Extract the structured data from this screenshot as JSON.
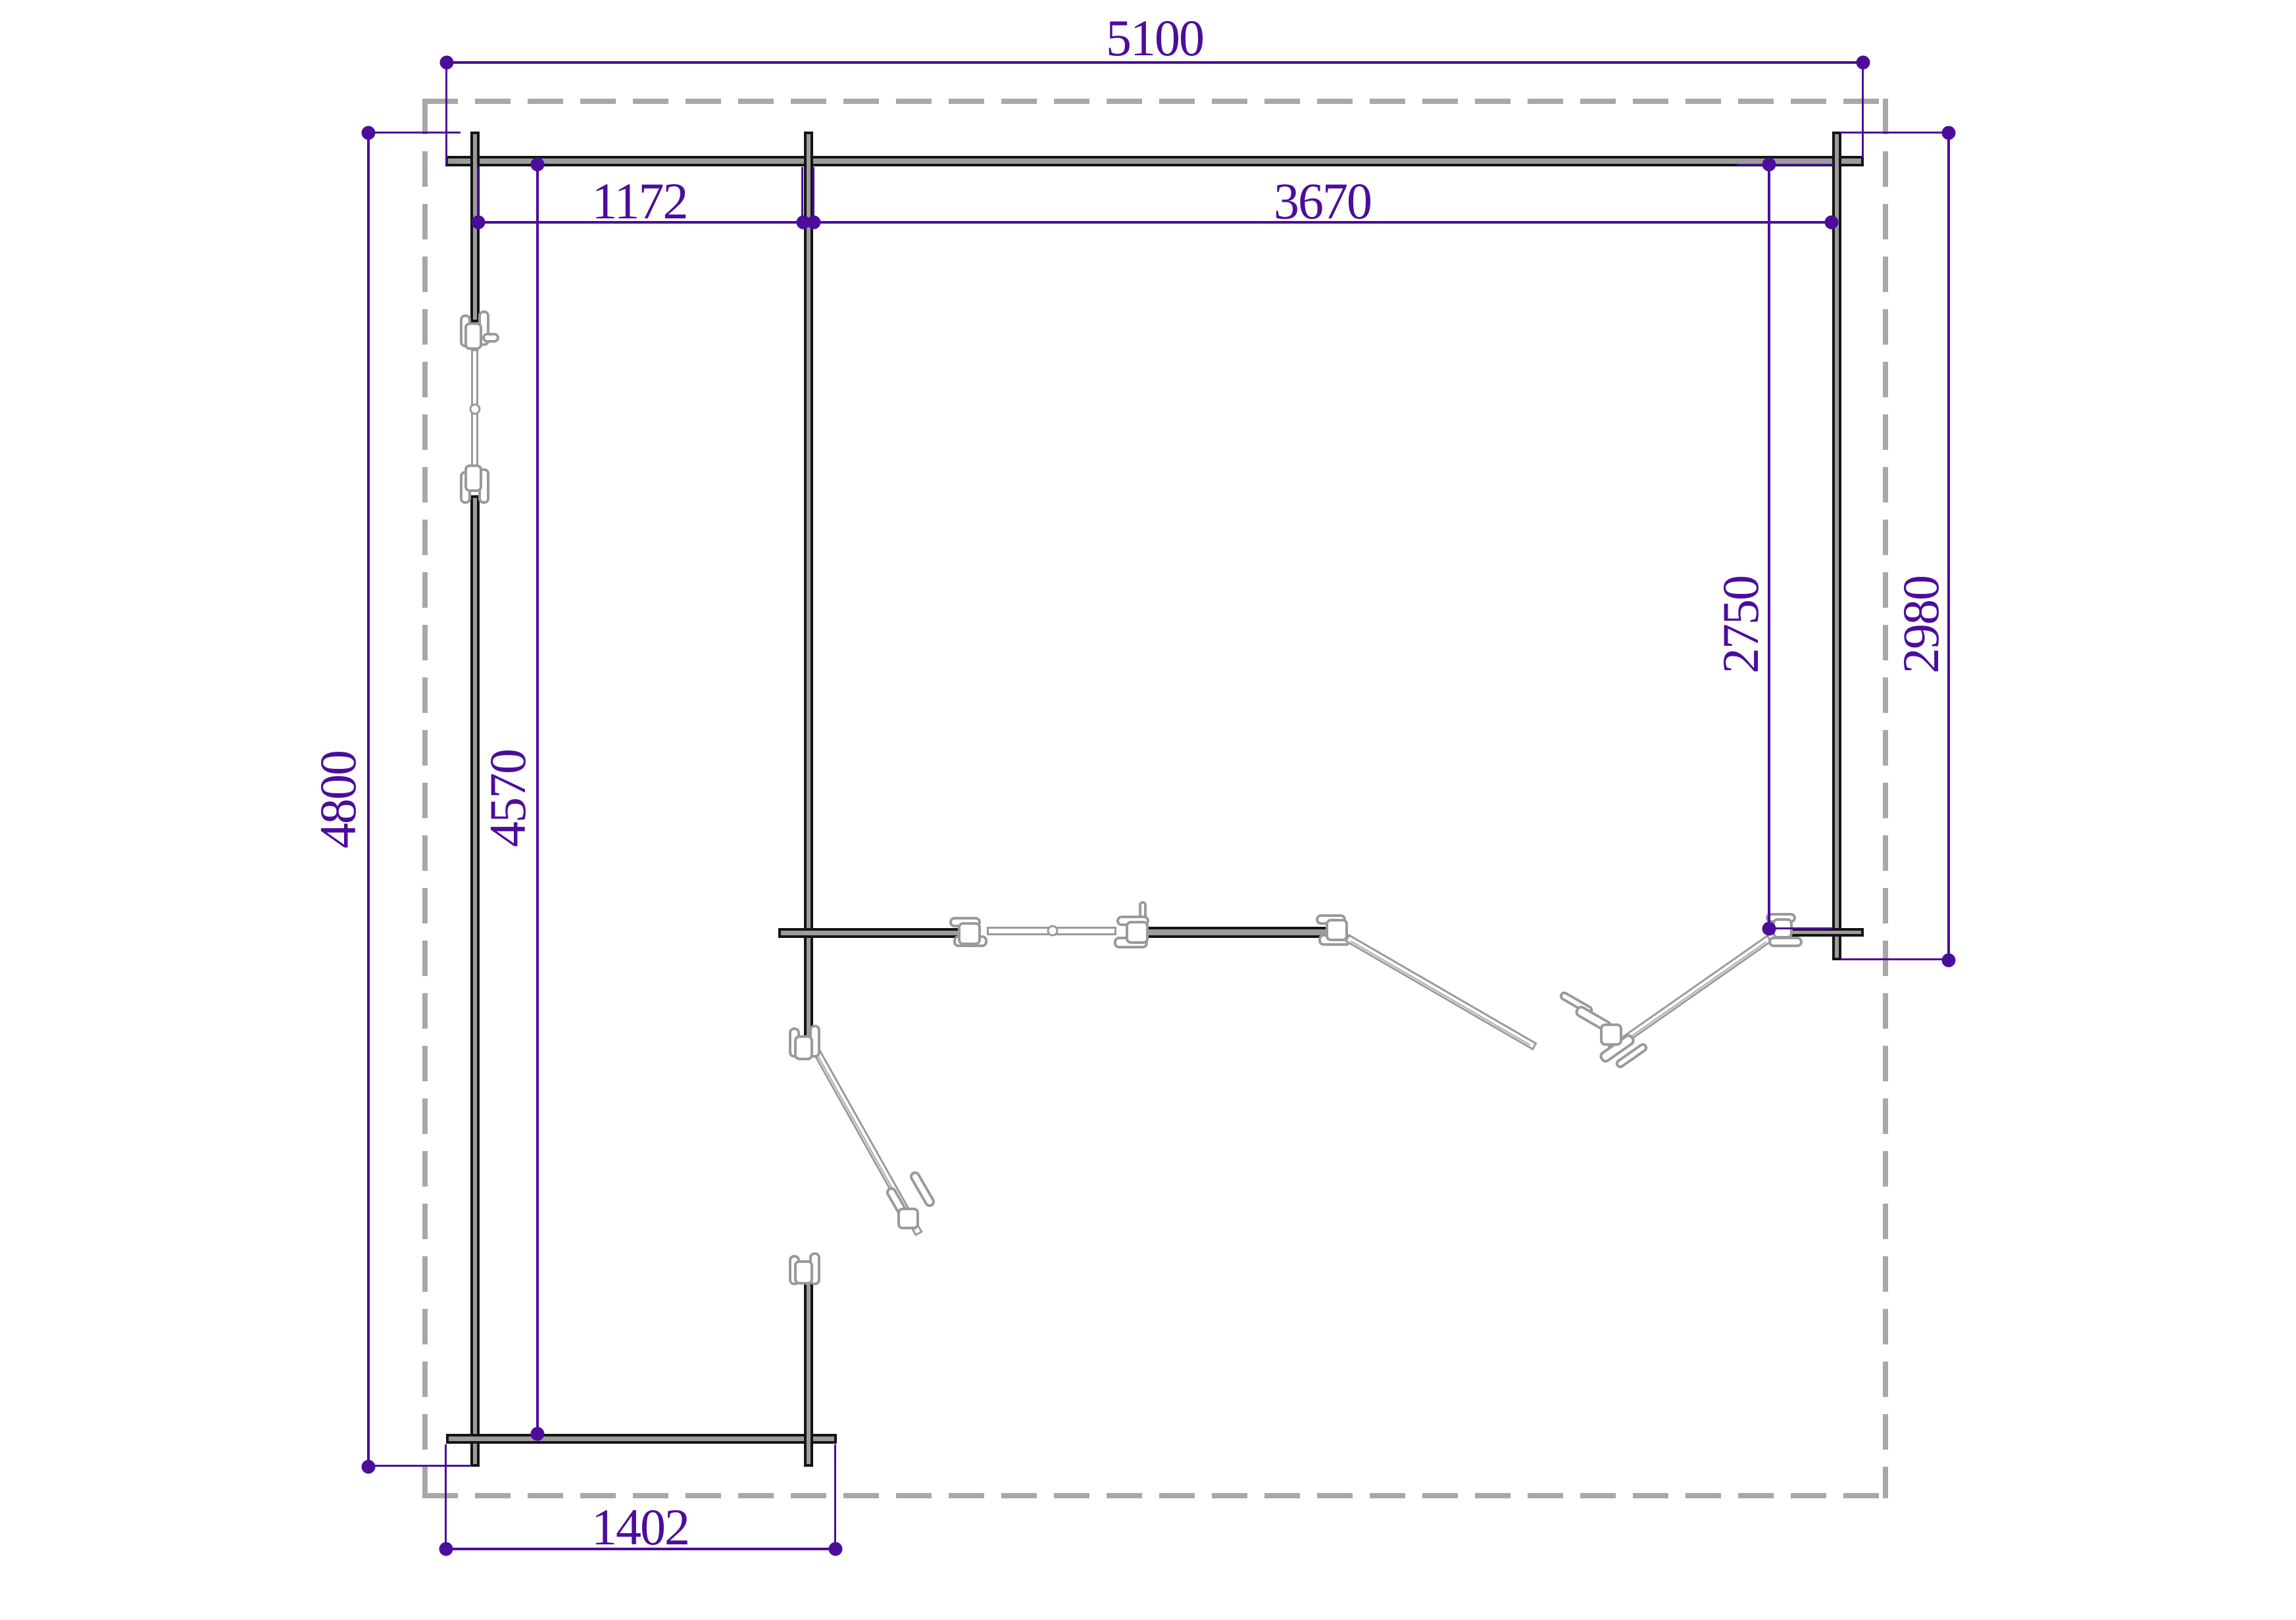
{
  "drawing": {
    "type": "floor-plan",
    "units": "mm",
    "dimensions": {
      "overall_width": "5100",
      "overall_depth": "4800",
      "bay_left_width": "1172",
      "main_room_width": "3670",
      "main_room_inner_depth": "2750",
      "right_wall_depth": "2980",
      "left_wing_inner_depth": "4570",
      "porch_width": "1402"
    },
    "colors": {
      "dimension_purple": "#4c0d9b",
      "wall_fill": "#9c9c9c",
      "wall_outline": "#141414",
      "door_outline": "#9a9a9a",
      "roof_dash_gray": "#a8a8a8",
      "background": "#ffffff"
    },
    "features": {
      "roof_overhang": "dashed-outline",
      "left_wall_window": "inline-leaf-with-hinges",
      "middle_partition": "folding-door-set",
      "left_wing_door": "single-swing-leaf",
      "open_terrace": "bottom-right-under-roof"
    }
  }
}
